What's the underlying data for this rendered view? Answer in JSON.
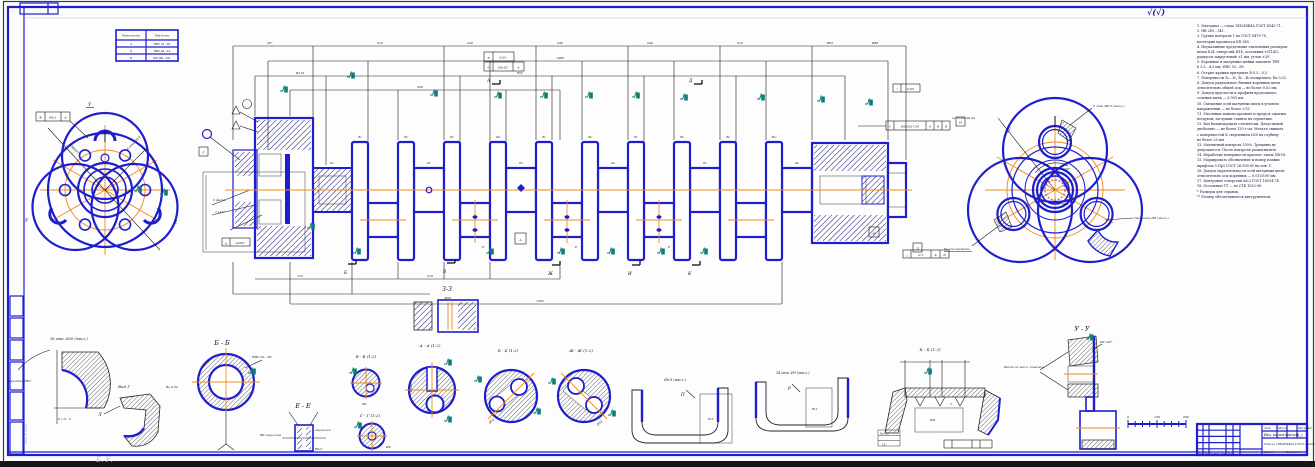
{
  "colors": {
    "blue": "#1e1ecd",
    "orange": "#ee8a1f",
    "teal": "#0c7d74",
    "hatch": "#15157a",
    "ink": "#141414"
  },
  "corner_mark": "√(√)",
  "ref_table": {
    "headers": [
      "Поверхность",
      "Твёрдость"
    ],
    "rows": [
      [
        "А",
        "HRC 52…58"
      ],
      [
        "Б",
        "HRC 48…54"
      ],
      [
        "В",
        "HB 269…341"
      ]
    ]
  },
  "left_view": {
    "gdt": {
      "sym": "⊕",
      "tol": "Ø0,1",
      "datum": "А"
    },
    "dim1": "Ø80H7",
    "dim2": "6 отв. Ø14",
    "marks": [
      "У",
      "У",
      "Z"
    ]
  },
  "inset": {
    "gdt": {
      "sym": "◎",
      "tol": "0,063"
    },
    "datum": "Г",
    "note1": "3 фаски",
    "note2": "1×45°"
  },
  "main_view": {
    "dims_top": [
      "45°",
      "210",
      "240",
      "240",
      "240",
      "210",
      "Ø95",
      "Ø88"
    ],
    "dims_mid": [
      "1485",
      "Ø110",
      "855",
      "320"
    ],
    "dims_bottom": [
      "125",
      "210",
      "1265"
    ],
    "web_labels": [
      "В₁",
      "В₂",
      "В₃",
      "В₄",
      "В₅",
      "В₆",
      "В₇",
      "В₈",
      "В₉",
      "В₁₀"
    ],
    "journal_labels": [
      "Б₁",
      "Б₂",
      "Б₃",
      "Б₄",
      "Б₅",
      "Б₆"
    ],
    "e_labels": [
      "Е",
      "Е",
      "Е"
    ],
    "arrows_top": [
      "А",
      "Д"
    ],
    "arrows_bottom": [
      "Б",
      "В",
      "Ж",
      "И",
      "К"
    ],
    "center_mark": "А",
    "gdt1": {
      "sym": "≡",
      "tol": "0,01"
    },
    "gdt2": {
      "sym": "⊙",
      "tol": "Ø0,05",
      "datum": "А"
    },
    "gdt3": {
      "sym": "◠",
      "tol": "0,05"
    },
    "gdt4": {
      "sym": "⌖",
      "tol": "Ø0,032 СМ",
      "d1": "А",
      "d2": "Б",
      "d3": "В"
    },
    "gdt5": {
      "sym": "⊥",
      "tol": "0,1",
      "d1": "А",
      "d2": "Б"
    },
    "datum_m": "М",
    "datum_d": "Д",
    "note_right": "на длине 100 мм"
  },
  "right_view": {
    "angle": "120°",
    "radius": "R47",
    "dim": "Ø50",
    "note_top": "2 отв. Ø8,5 (масл.)",
    "note_left": "Балансировать",
    "note_right": "Сверлить Ø8 (масл.)",
    "datum": "И"
  },
  "tech_req": {
    "lines": [
      "1. Материал — сталь 18Х2Н4МА ГОСТ 4543-71.",
      "2. HB 269…341.",
      "3. Группа контроля 1 по ГОСТ 8479-70,",
      "категория прочности КП 685.",
      "4. Неуказанные предельные отклонения размеров:",
      "валов h14, отверстий H14, остальных ±IT14/2,",
      "радиусов закруглений ±1 мм, углов ±30'.",
      "5. Коренные и шатунные шейки закалить ТВЧ",
      "h 2,5…4,5 мм; HRC 52…58.",
      "6. Острые кромки притупить R 0,3…0,5.",
      "7. Поверхности Б₁…Б₇, В₁…В₅ полировать, Ra 0,32.",
      "8. Допуск радиального биения коренных шеек",
      "относительно общей оси — не более 0,02 мм.",
      "9. Допуск круглости и профиля продольного",
      "сечения шеек — 0,005 мм.",
      "10. Смещение осей шатунных шеек в угловом",
      "направлении — не более ±15'.",
      "11. Масляные каналы промыть и продуть сжатым",
      "воздухом; заглушки ставить на герметике.",
      "12. Вал балансировать статически. Допустимый",
      "дисбаланс — не более 120 г·см. Металл снимать",
      "с поверхностей К сверлением Ø20 на глубину",
      "не более 25 мм.",
      "13. Магнитный контроль 100%. Трещины не",
      "допускаются. После контроля размагнитить.",
      "14. Нерабочие поверхности красить: эмаль ХВ-16.",
      "15. Маркировать обозначение и номер плавки",
      "шрифтом 5-Пр3 ГОСТ 26.008-85 на пов. Т.",
      "16. Допуск параллельности осей шатунных шеек",
      "относительно оси коренных — 0,015/100 мм.",
      "17. Центровые отверстия A6,3 ГОСТ 14034-74.",
      "18. Остальные ТТ — по СТБ 1022-96.",
      "*  Размеры для справок.",
      "** Размер обеспечивается инструментом."
    ]
  },
  "sections": {
    "zz": {
      "label": "З-З",
      "dim": "Ø20"
    },
    "oil": {
      "label": "16 отв. Ø20 (масл.)",
      "note1": "Закалить ТВЧ",
      "note2": "h 1,5…3"
    },
    "vg": {
      "label": "Вид Г",
      "leader": "Л"
    },
    "bb": {
      "label": "Б - Б",
      "note1": "HRC 52…58",
      "note2": "Ra 0,32"
    },
    "ee": {
      "label": "Е - Е",
      "note1": "Ø9 (керосин)",
      "note2": "эмульсия",
      "note3": "R0,5"
    },
    "vv": {
      "label": "В - В (1:2)",
      "dim": "Ø9"
    },
    "gg": {
      "label": "Г - Г (1:2)",
      "dim": "Ø9"
    },
    "aa": {
      "label": "А - А (1:2)",
      "dim": "Ø140"
    },
    "bb2": {
      "label": "Б - Б (1:2)",
      "dim": "Ø52"
    },
    "jj": {
      "label": "Ж - Ж (1:2)",
      "dim": "Ø52"
    },
    "cw1": {
      "label": "Ø6,9 (масл.)",
      "leader": "П",
      "dim": "R15"
    },
    "cw2": {
      "label": "14 отв. Ø9 (масл.)",
      "leader": "Р",
      "dim": "R12"
    },
    "kk": {
      "label": "К - К (1:2)",
      "d1": "Ra 1,6",
      "d2": "Ø92",
      "d3": "15°",
      "tri": "▽"
    },
    "uu": {
      "label": "У - У",
      "note_left": "Фаски по масл. каналам",
      "note_top": "Ø2×45°"
    }
  },
  "scale_bar": {
    "ticks": [
      "0",
      "100",
      "200"
    ]
  },
  "title_block": {
    "name": "Вал коленчатый",
    "material": "Сталь 18Х2Н4МА ГОСТ 4543-71",
    "scale": "1:2",
    "lit": "Лит.",
    "mass": "Масса",
    "masht": "Масштаб",
    "stamp": "Изм. Лист  № докум.  Подп.  Дата",
    "sheet": "Лист 1",
    "sheets": "Листов 1"
  },
  "watermark": "Б. У.",
  "side_note": "Инв. № подл."
}
